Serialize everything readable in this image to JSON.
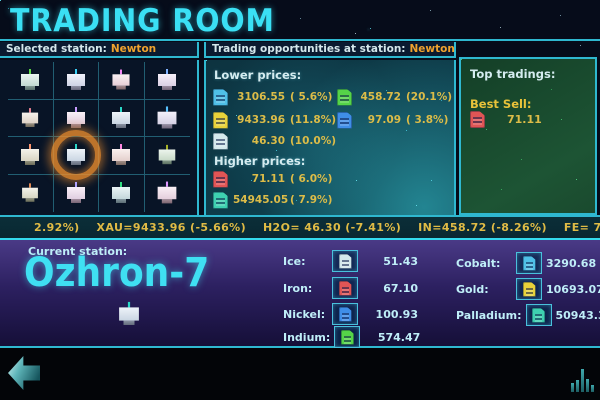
{
  "title": "TRADING ROOM",
  "colors": {
    "accent_cyan": "#3ae0f4",
    "station_orange": "#f0a22e",
    "value_yellow": "#dcbc48",
    "highlight_ring_orange": "#eb8c2d"
  },
  "selected_station_panel": {
    "label": "Selected station:",
    "station": "Newton",
    "grid_rows": 4,
    "grid_cols": 4,
    "selected_cell": "row 3, col 2"
  },
  "opportunities_panel": {
    "label": "Trading opportunities at station:",
    "station": "Newton",
    "lower_prices_label": "Lower prices:",
    "lower_prices": [
      {
        "commodity": "cobalt",
        "price": "3106.55",
        "change": "( 5.6%)",
        "color": "#4fc0e8"
      },
      {
        "commodity": "indium",
        "price": "458.72",
        "change": "(20.1%)",
        "color": "#55d448"
      },
      {
        "commodity": "gold",
        "price": "9433.96",
        "change": "(11.8%)",
        "color": "#e8d23a"
      },
      {
        "commodity": "nickel",
        "price": "97.09",
        "change": "( 3.8%)",
        "color": "#3f8ee8"
      },
      {
        "commodity": "ice",
        "price": "46.30",
        "change": "(10.0%)",
        "color": "#d4e8ec"
      }
    ],
    "higher_prices_label": "Higher prices:",
    "higher_prices": [
      {
        "commodity": "iron",
        "price": "71.11",
        "change": "( 6.0%)",
        "color": "#e05555"
      },
      {
        "commodity": "palladium",
        "price": "54945.05",
        "change": "( 7.9%)",
        "color": "#3ed0b0"
      }
    ]
  },
  "top_tradings_panel": {
    "label": "Top tradings:",
    "best_sell_label": "Best Sell:",
    "best_sell": {
      "commodity": "iron",
      "price": "71.11",
      "color": "#e05555"
    }
  },
  "ticker": {
    "text": "2.92%)    XAU=9433.96 (-5.66%)    H2O= 46.30 (-7.41%)    IN=458.72 (-8.26%)    FE= 71.11 (11.11%)    NI= 97.09 (-2.91%)    XPD=54945"
  },
  "current_station_panel": {
    "label": "Current station:",
    "name": "Ozhron-7",
    "commodities_col1": [
      {
        "label": "Ice:",
        "value": "51.43",
        "color": "#d4e8ec"
      },
      {
        "label": "Iron:",
        "value": "67.10",
        "color": "#e05555"
      },
      {
        "label": "Nickel:",
        "value": "100.93",
        "color": "#3f8ee8"
      },
      {
        "label": "Indium:",
        "value": "574.47",
        "color": "#55d448"
      }
    ],
    "commodities_col2": [
      {
        "label": "Cobalt:",
        "value": "3290.68",
        "color": "#4fc0e8"
      },
      {
        "label": "Gold:",
        "value": "10693.07",
        "color": "#e8d23a"
      },
      {
        "label": "Palladium:",
        "value": "50943.39",
        "color": "#3ed0b0"
      }
    ]
  },
  "bottom_bar": {
    "back_icon": "back-arrow-icon",
    "chart_icon": "bar-chart-icon"
  }
}
